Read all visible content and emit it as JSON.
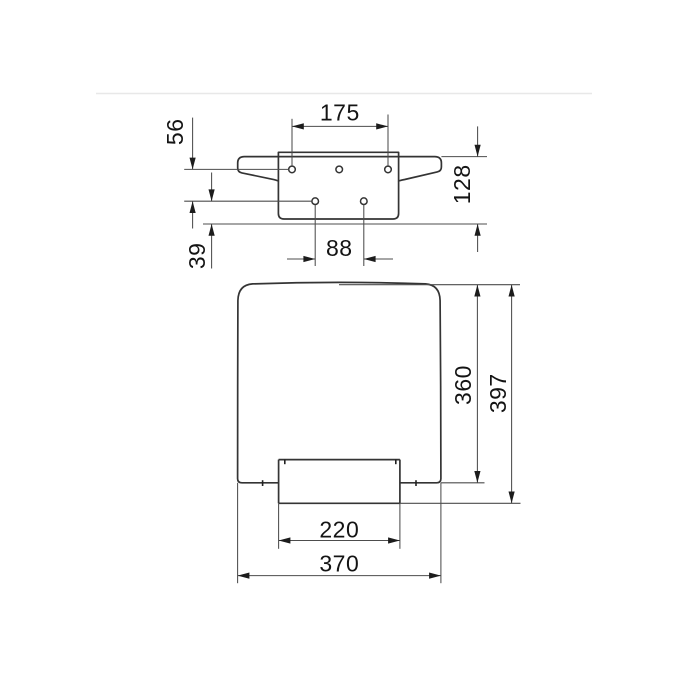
{
  "drawing": {
    "kind": "technical-dimension-drawing",
    "background_color": "#ffffff",
    "object_line_color": "#343434",
    "dimension_line_color": "#4d4d4d",
    "text_color": "#141414",
    "divider_color": "#e8e8e8",
    "top_view": {
      "dim_top_hole_spacing": "175",
      "dim_hole_row_gap": "56",
      "dim_plate_height": "128",
      "dim_bottom_hole_spacing": "88",
      "dim_bottom_row_to_edge": "39"
    },
    "front_view": {
      "dim_seat_height": "360",
      "dim_total_height": "397",
      "dim_flap_width": "220",
      "dim_seat_width": "370"
    }
  }
}
